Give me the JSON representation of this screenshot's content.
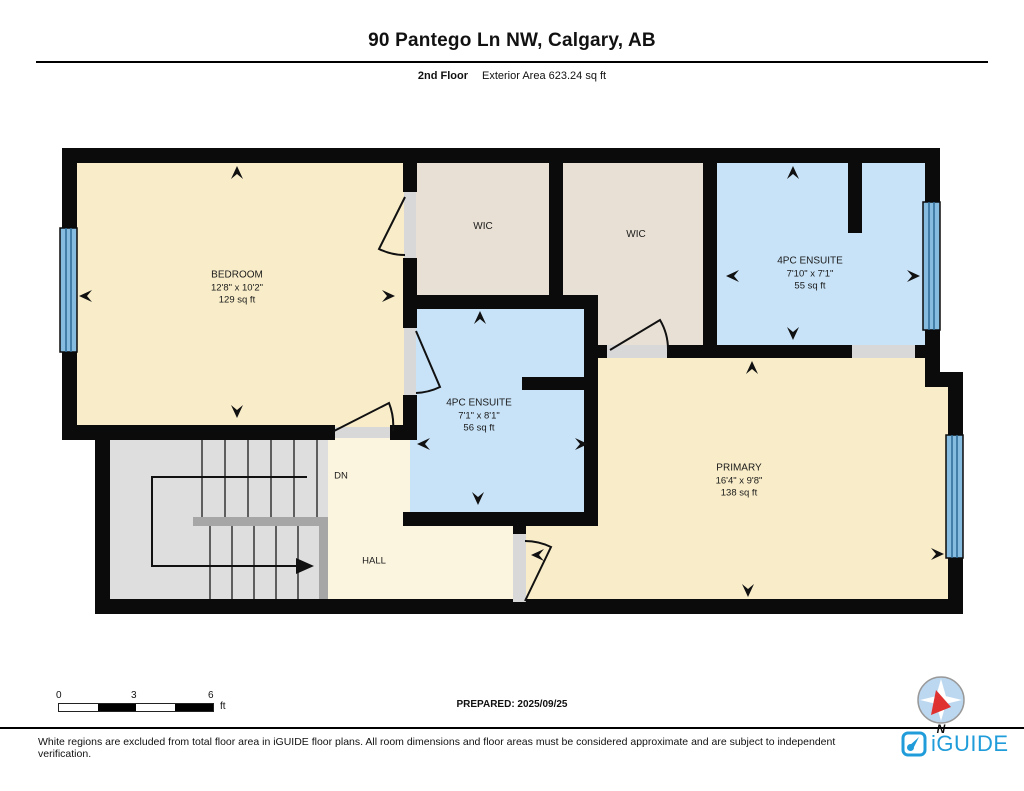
{
  "header": {
    "title": "90 Pantego Ln NW, Calgary, AB",
    "floor_label": "2nd Floor",
    "area_label": "Exterior Area 623.24 sq ft"
  },
  "rooms": {
    "bedroom": {
      "name": "BEDROOM",
      "dims": "12'8\" x 10'2\"",
      "area": "129 sq ft"
    },
    "wic_left": {
      "name": "WIC"
    },
    "wic_right": {
      "name": "WIC"
    },
    "ensuite_top": {
      "name": "4PC ENSUITE",
      "dims": "7'10\" x 7'1\"",
      "area": "55 sq ft"
    },
    "ensuite_mid": {
      "name": "4PC ENSUITE",
      "dims": "7'1\" x 8'1\"",
      "area": "56 sq ft"
    },
    "primary": {
      "name": "PRIMARY",
      "dims": "16'4\" x 9'8\"",
      "area": "138 sq ft"
    },
    "hall": {
      "name": "HALL"
    },
    "stairs": {
      "label": "DN"
    }
  },
  "scale": {
    "t0": "0",
    "t1": "3",
    "t2": "6",
    "unit": "ft"
  },
  "prepared_label": "PREPARED: 2025/09/25",
  "compass": {
    "north": "N"
  },
  "footer": {
    "disclaimer": "White regions are excluded from total floor area in iGUIDE floor plans. All room dimensions and floor areas must be considered approximate and are subject to independent verification.",
    "brand": "iGUIDE"
  },
  "colors": {
    "room_fill": "#F9EDC9",
    "hall_fill": "#FBF4DE",
    "closet_fill": "#E8E0D4",
    "bath_fill": "#C8E3F8",
    "stair_fill": "#DEDEDE",
    "window_blue": "#85BCDF",
    "wall_black": "#0B0B0B",
    "brand_blue": "#1F9CD9",
    "compass_red": "#E03131"
  }
}
